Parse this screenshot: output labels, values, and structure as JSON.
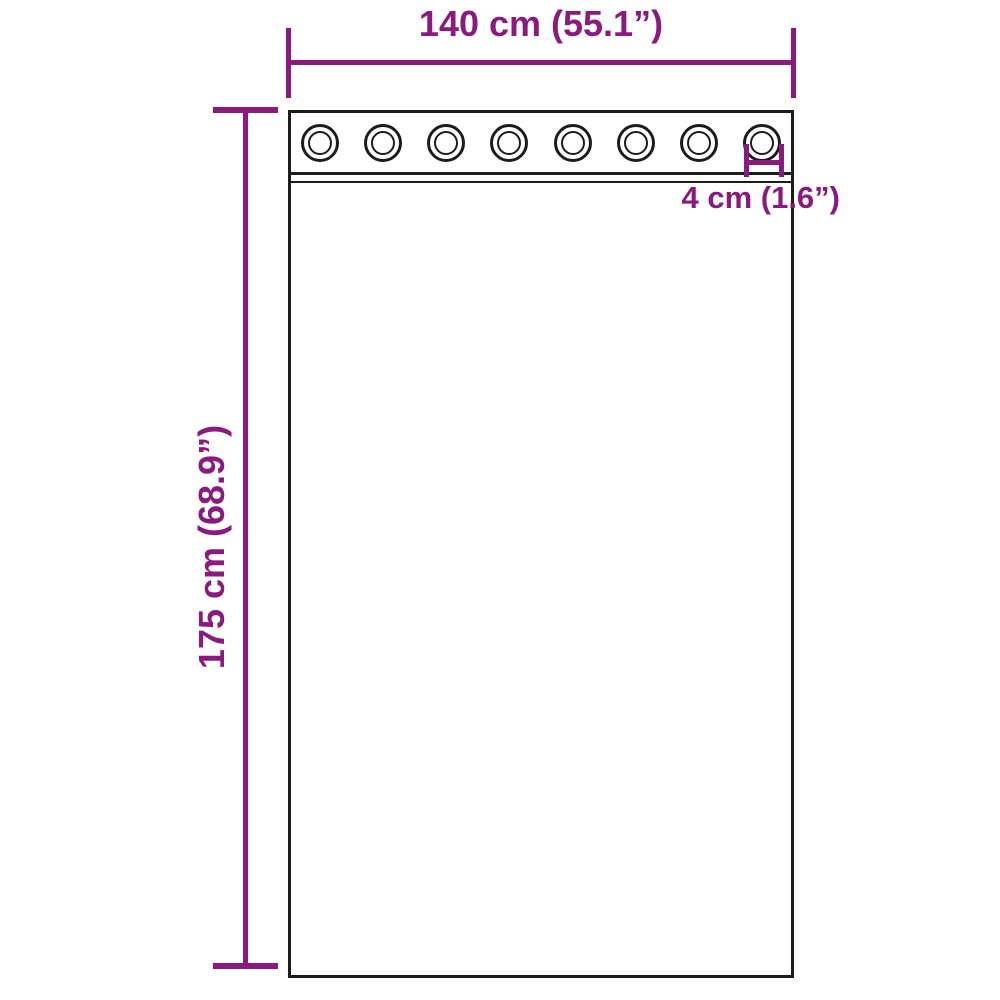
{
  "colors": {
    "accent": "#8B1A7F",
    "outline": "#1C1C1C",
    "background": "#FFFFFF"
  },
  "diagram": {
    "subject": "curtain panel with grommet top",
    "grommet_count": 8
  },
  "dimensions": {
    "width": {
      "label": "140 cm (55.1”)"
    },
    "height": {
      "label": "175 cm (68.9”)"
    },
    "grommet": {
      "label": "4 cm (1.6”)"
    }
  }
}
